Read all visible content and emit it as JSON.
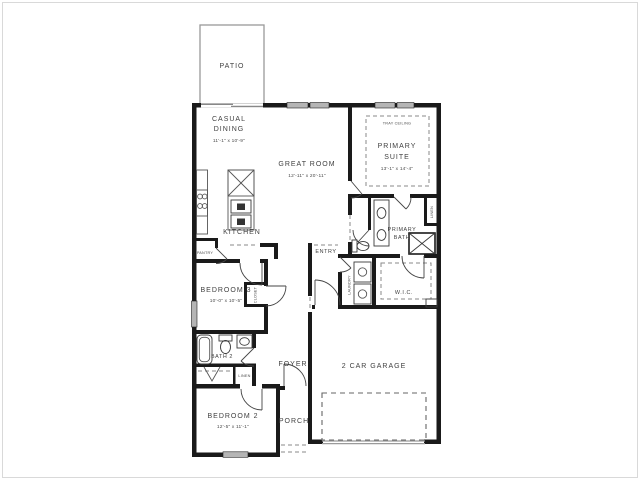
{
  "colors": {
    "wall": "#1a1a1a",
    "text": "#414141",
    "window_fill": "#b5b5b5",
    "background": "#ffffff",
    "dashed_line": "#8a8a8a"
  },
  "plan": {
    "patio": {
      "label": "PATIO"
    },
    "casual_dining": {
      "line1": "CASUAL",
      "line2": "DINING",
      "dims": "11'-1\" x 10'-9\""
    },
    "great_room": {
      "label": "GREAT ROOM",
      "dims": "12'-11\" x 20'-11\""
    },
    "primary_suite": {
      "ceiling": "TRAY CEILING",
      "line1": "PRIMARY",
      "line2": "SUITE",
      "dims": "13'-1\" x 14'-4\""
    },
    "kitchen": {
      "label": "KITCHEN"
    },
    "pantry": {
      "label": "PANTRY"
    },
    "entry": {
      "label": "ENTRY"
    },
    "primary_bath": {
      "line1": "PRIMARY",
      "line2": "BATH"
    },
    "laundry": {
      "label": "LAUNDRY"
    },
    "wic": {
      "label": "W.I.C."
    },
    "linen_primary": {
      "label": "LINEN"
    },
    "bedroom3": {
      "label": "BEDROOM 3",
      "dims": "10'-0\" x 10'-5\""
    },
    "closet_bedroom3": {
      "label": "CLOSET"
    },
    "bath2": {
      "label": "BATH 2"
    },
    "linen_hall": {
      "label": "LINEN"
    },
    "foyer": {
      "label": "FOYER"
    },
    "bedroom2": {
      "label": "BEDROOM 2",
      "dims": "12'-5\" x 11'-1\""
    },
    "porch": {
      "label": "PORCH"
    },
    "garage": {
      "label": "2 CAR GARAGE"
    }
  }
}
